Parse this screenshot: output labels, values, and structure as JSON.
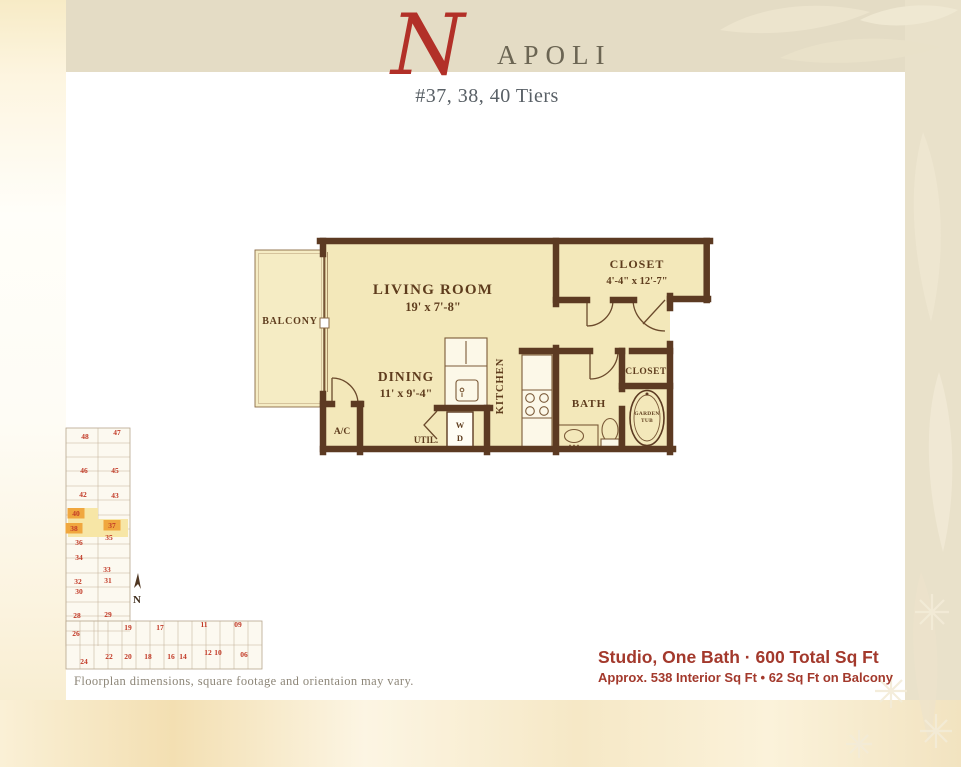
{
  "title": {
    "initial": "N",
    "rest": "APOLI",
    "subtitle": "#37, 38, 40 Tiers"
  },
  "floorplan": {
    "labels": {
      "living_name": "LIVING ROOM",
      "living_dims": "19' x 7'-8\"",
      "dining_name": "DINING",
      "dining_dims": "11' x 9'-4\"",
      "balcony": "BALCONY",
      "closet_large_name": "CLOSET",
      "closet_large_dims": "4'-4\" x 12'-7\"",
      "kitchen": "KITCHEN",
      "bath": "BATH",
      "closet_small": "CLOSET",
      "garden_tub_line1": "GARDEN",
      "garden_tub_line2": "TUB",
      "ac": "A/C",
      "util": "UTIL.",
      "washer": "W",
      "dryer": "D"
    }
  },
  "site_map": {
    "north_label": "N",
    "highlighted_units": [
      "40",
      "38",
      "37"
    ],
    "units": [
      {
        "label": "48",
        "x": 25,
        "y": 16
      },
      {
        "label": "47",
        "x": 57,
        "y": 12
      },
      {
        "label": "46",
        "x": 24,
        "y": 50
      },
      {
        "label": "45",
        "x": 55,
        "y": 50
      },
      {
        "label": "42",
        "x": 23,
        "y": 74
      },
      {
        "label": "43",
        "x": 55,
        "y": 75
      },
      {
        "label": "40",
        "x": 16,
        "y": 93,
        "highlighted": true
      },
      {
        "label": "38",
        "x": 14,
        "y": 108,
        "highlighted": true
      },
      {
        "label": "37",
        "x": 52,
        "y": 105,
        "highlighted": true
      },
      {
        "label": "36",
        "x": 19,
        "y": 122
      },
      {
        "label": "35",
        "x": 49,
        "y": 117
      },
      {
        "label": "34",
        "x": 19,
        "y": 137
      },
      {
        "label": "33",
        "x": 47,
        "y": 149
      },
      {
        "label": "32",
        "x": 18,
        "y": 161
      },
      {
        "label": "31",
        "x": 48,
        "y": 160
      },
      {
        "label": "30",
        "x": 19,
        "y": 171
      },
      {
        "label": "28",
        "x": 17,
        "y": 195
      },
      {
        "label": "29",
        "x": 48,
        "y": 194
      },
      {
        "label": "26",
        "x": 16,
        "y": 213
      },
      {
        "label": "24",
        "x": 24,
        "y": 241
      },
      {
        "label": "22",
        "x": 49,
        "y": 236
      },
      {
        "label": "19",
        "x": 68,
        "y": 207
      },
      {
        "label": "20",
        "x": 68,
        "y": 236
      },
      {
        "label": "17",
        "x": 100,
        "y": 207
      },
      {
        "label": "18",
        "x": 88,
        "y": 236
      },
      {
        "label": "16",
        "x": 111,
        "y": 236
      },
      {
        "label": "14",
        "x": 123,
        "y": 236
      },
      {
        "label": "11",
        "x": 144,
        "y": 204
      },
      {
        "label": "09",
        "x": 178,
        "y": 204
      },
      {
        "label": "12",
        "x": 148,
        "y": 232
      },
      {
        "label": "10",
        "x": 158,
        "y": 232
      },
      {
        "label": "06",
        "x": 184,
        "y": 234
      }
    ]
  },
  "footer": {
    "disclaimer": "Floorplan dimensions, square footage and orientaion may vary.",
    "summary_line1": "Studio, One Bath · 600 Total Sq Ft",
    "summary_line2": "Approx. 538 Interior Sq Ft • 62 Sq Ft on Balcony"
  },
  "colors": {
    "wall_brown": "#5c3a22",
    "floor_yellow": "#f3e8ba",
    "accent_red": "#b23028",
    "summary_red": "#a3392c",
    "unit_number_red": "#c23a27",
    "highlight_orange": "#f0a73f",
    "highlight_yellow": "#f7e6a6",
    "band_beige": "#e4dcc5"
  }
}
